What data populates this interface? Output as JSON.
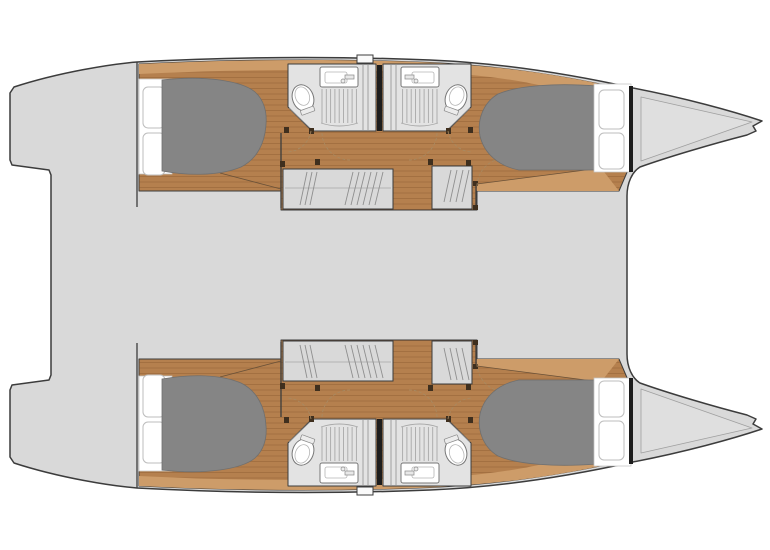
{
  "canvas": {
    "width": 770,
    "height": 550,
    "background": "#ffffff"
  },
  "diagram": {
    "type": "floor-plan",
    "subject": "catamaran-yacht-4-cabin-layout",
    "orientation": "bow-right",
    "symmetry": "mirrored-about-horizontal-centerline"
  },
  "colors": {
    "white": "#ffffff",
    "deck": "#d9d9d9",
    "line": "#3c3c3c",
    "line_soft": "#8f8f8f",
    "wood": "#b5804e",
    "wood_light": "#cd9c69",
    "plank": "#7a4e24",
    "bed": "#858585",
    "bed_line": "#6f6f6f",
    "bath": "#e3e3e3",
    "fixture": "#ffffff",
    "fixture_line": "#777777",
    "grate": "#a8a8a8",
    "stair": "#d9d9d9",
    "hatch": "#8f8f8f",
    "wall_black": "#1d1d1d",
    "post": "#3f2f1e",
    "cushion_line": "#bdbdbd",
    "door_arc": "#a78a63"
  },
  "hulls": [
    {
      "side": "port",
      "position": "top",
      "rooms": [
        {
          "name": "aft-cabin",
          "features": [
            "double-berth",
            "berth-cushions",
            "wood-floor"
          ]
        },
        {
          "name": "head-aft",
          "features": [
            "toilet",
            "sink-with-faucet",
            "shower-grate"
          ]
        },
        {
          "name": "head-forward",
          "features": [
            "toilet",
            "sink-with-faucet",
            "shower-grate"
          ]
        },
        {
          "name": "companionway",
          "features": [
            "stairs-aft",
            "stairs-forward",
            "door-swings"
          ]
        },
        {
          "name": "forward-cabin",
          "features": [
            "double-berth",
            "berth-cushions",
            "wood-floor"
          ]
        },
        {
          "name": "bow-locker",
          "features": [
            "anchor-fitting"
          ]
        }
      ]
    },
    {
      "side": "starboard",
      "position": "bottom",
      "rooms": [
        {
          "name": "aft-cabin",
          "features": [
            "double-berth",
            "berth-cushions",
            "wood-floor"
          ]
        },
        {
          "name": "head-aft",
          "features": [
            "toilet",
            "sink-with-faucet",
            "shower-grate"
          ]
        },
        {
          "name": "head-forward",
          "features": [
            "toilet",
            "sink-with-faucet",
            "shower-grate"
          ]
        },
        {
          "name": "companionway",
          "features": [
            "stairs-aft",
            "stairs-forward",
            "door-swings"
          ]
        },
        {
          "name": "forward-cabin",
          "features": [
            "double-berth",
            "berth-cushions",
            "wood-floor"
          ]
        },
        {
          "name": "bow-locker",
          "features": [
            "anchor-fitting"
          ]
        }
      ]
    }
  ],
  "deck_areas": [
    {
      "name": "stern-platform-port"
    },
    {
      "name": "stern-platform-starboard"
    },
    {
      "name": "aft-cockpit"
    },
    {
      "name": "main-bridgedeck"
    },
    {
      "name": "foredeck"
    }
  ]
}
